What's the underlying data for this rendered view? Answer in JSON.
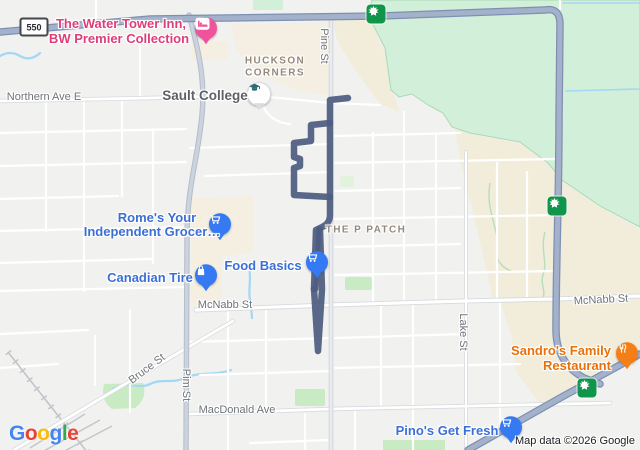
{
  "attribution": "Map data ©2026 Google",
  "logo": {
    "l1": "G",
    "l2": "o",
    "l3": "o",
    "l4": "g",
    "l5": "l",
    "l6": "e"
  },
  "shields": {
    "hwy550": "550"
  },
  "area_labels": {
    "huckson1": "HUCKSON",
    "huckson2": "CORNERS",
    "p_patch": "THE P PATCH"
  },
  "streets": {
    "northern": "Northern Ave E",
    "pine": "Pine St",
    "mcnabb_left": "McNabb St",
    "mcnabb_right": "McNabb St",
    "lake": "Lake St",
    "bruce": "Bruce St",
    "pim": "Pim St",
    "macdonald": "MacDonald Ave"
  },
  "pois": {
    "water_tower": {
      "line1": "The Water Tower Inn,",
      "line2": "BW Premier Collection"
    },
    "sault_college": {
      "label": "Sault College"
    },
    "romes": {
      "line1": "Rome's Your",
      "line2": "Independent Grocer…"
    },
    "canadian_tire": {
      "label": "Canadian Tire"
    },
    "food_basics": {
      "label": "Food Basics"
    },
    "sandros": {
      "line1": "Sandro's Family",
      "line2": "Restaurant"
    },
    "pinos": {
      "label": "Pino's Get Fresh"
    }
  },
  "colors": {
    "route": "#4d5c80",
    "poi_blue": "#3b6fd6",
    "hotel_pink": "#de3d78",
    "restaurant_orange": "#e8710a",
    "badge_green": "#10964b",
    "park_green": "#c9ebc4",
    "nature_green": "#d2efd9",
    "golf_tan": "#f2ecda",
    "highway_fill": "#a3b1cb",
    "water_blue": "#a3d7f2"
  }
}
